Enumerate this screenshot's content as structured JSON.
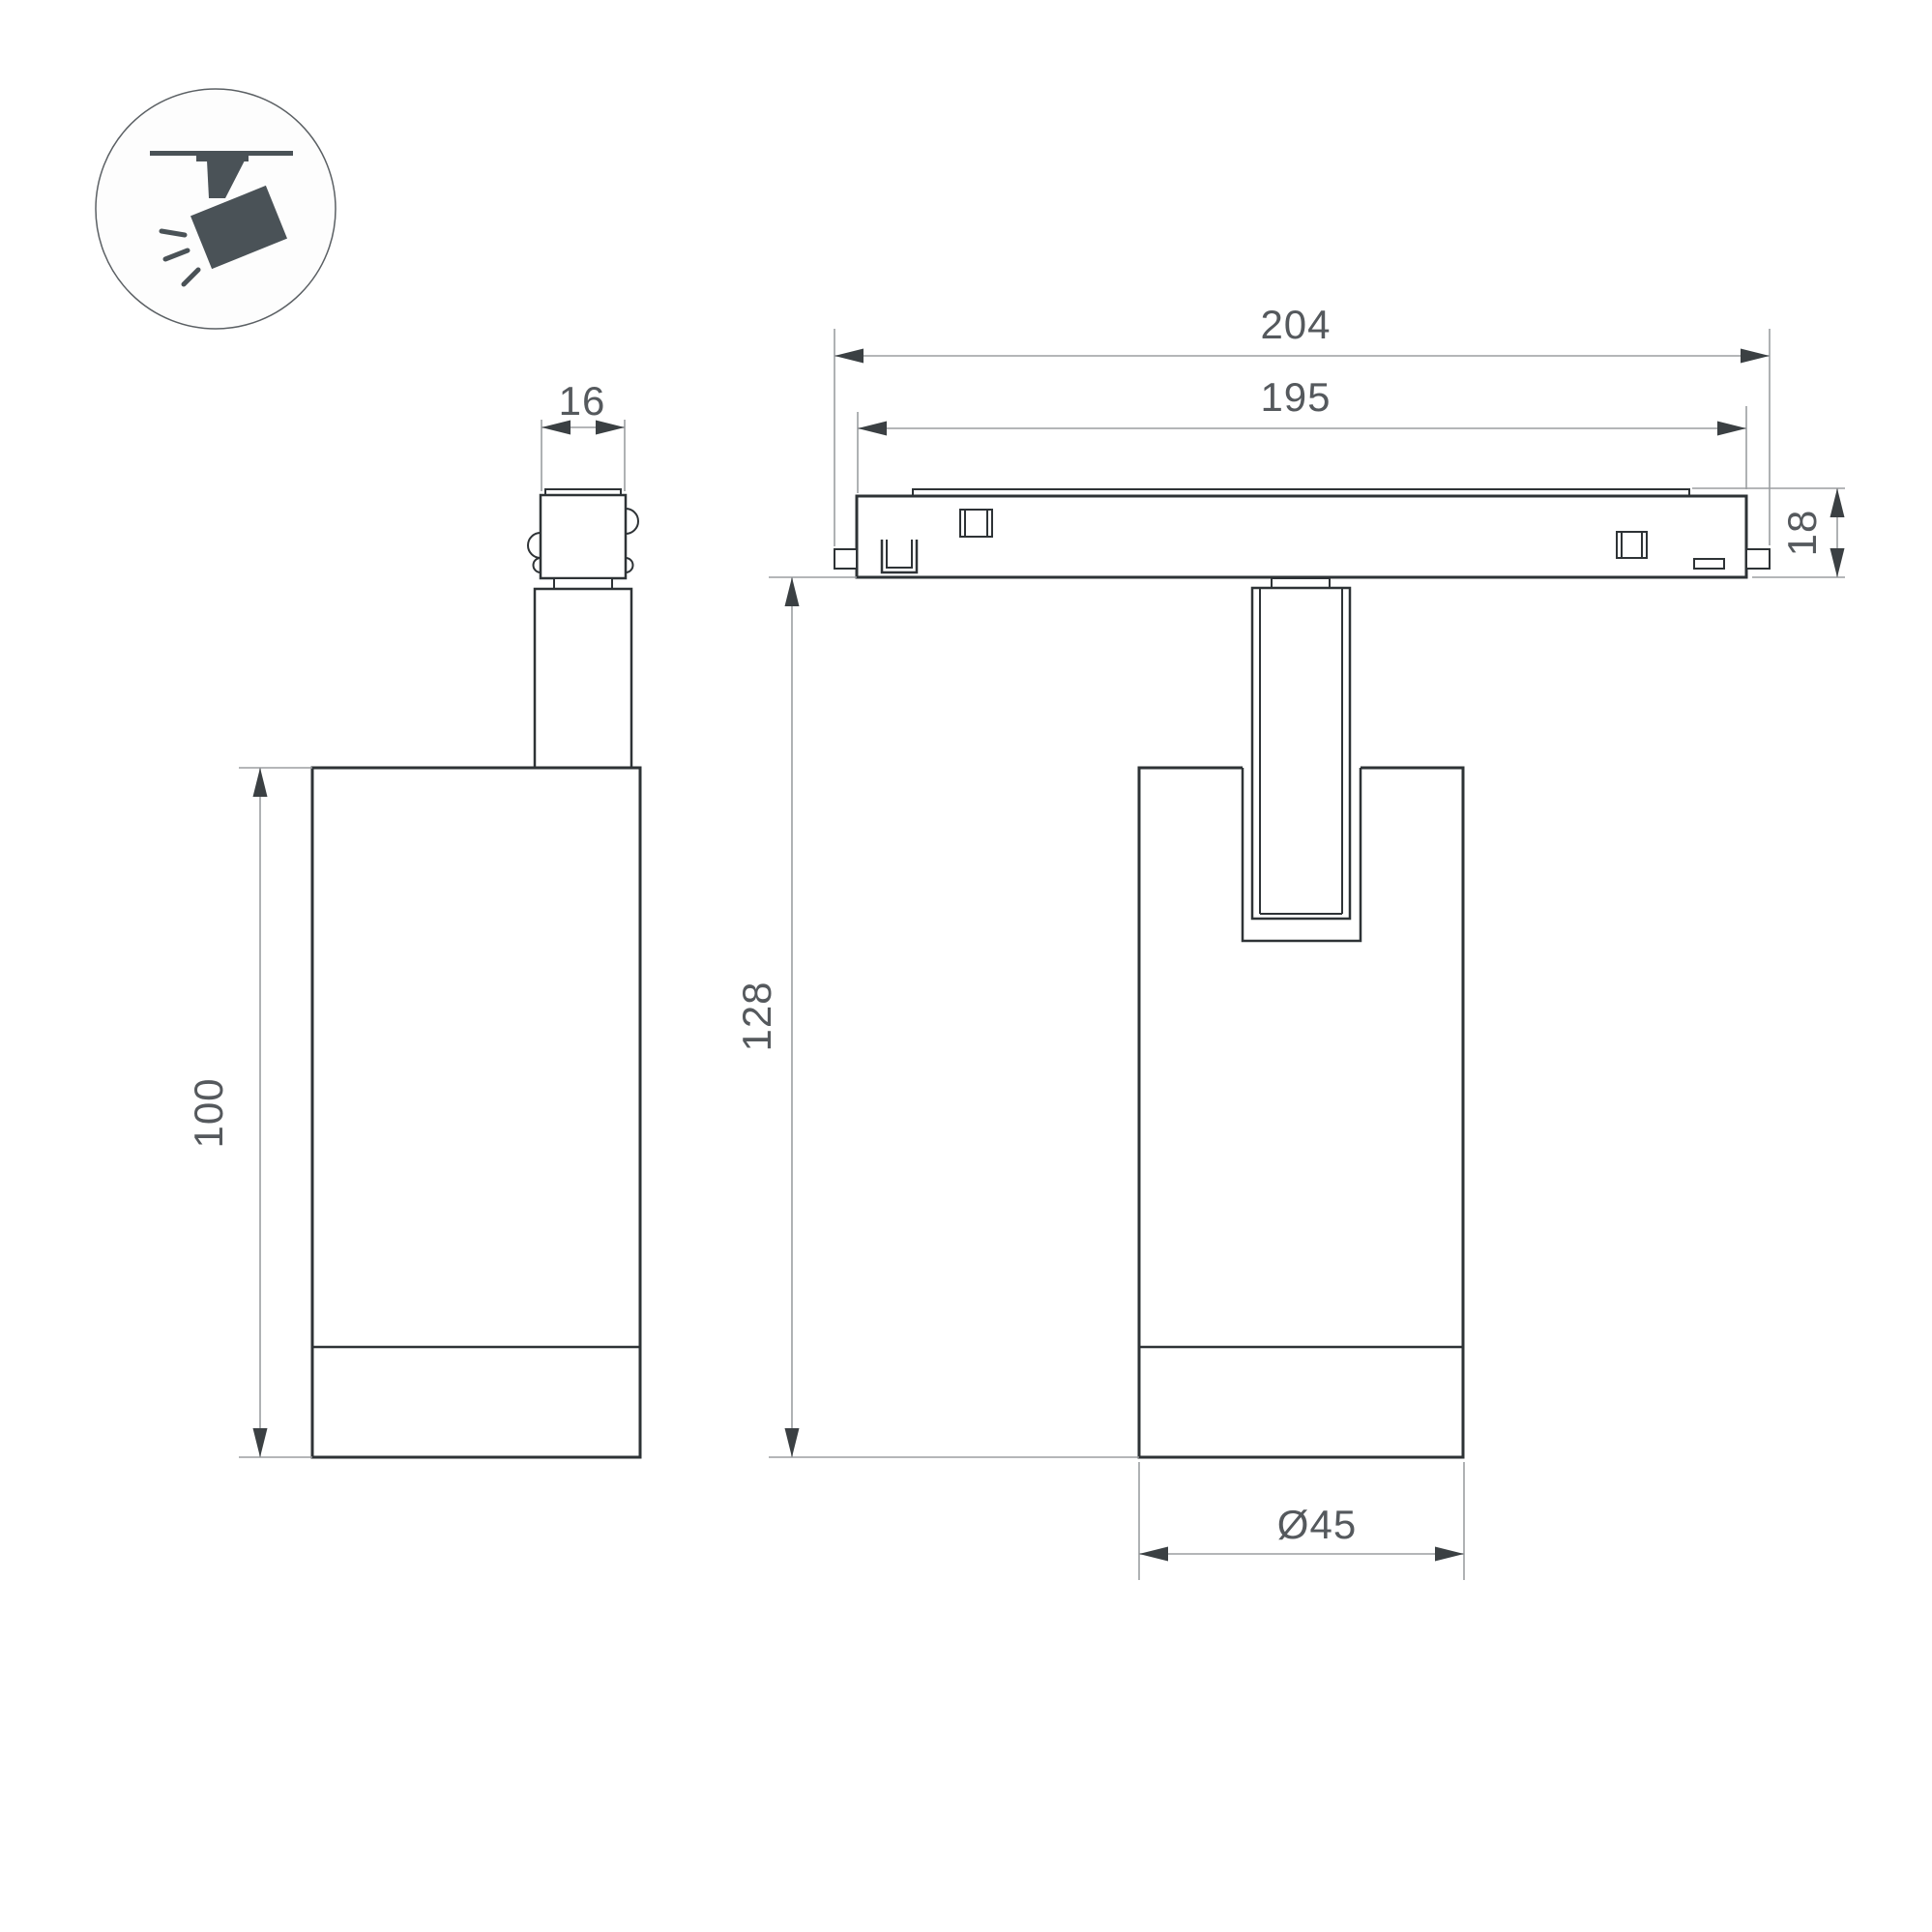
{
  "icon": {
    "name": "ceiling-track-spotlight-pictogram"
  },
  "dimensions": {
    "track_overall_length": "204",
    "track_body_length": "195",
    "adapter_width": "16",
    "track_height": "18",
    "overall_height": "128",
    "body_height": "100",
    "body_diameter": "Ø45"
  },
  "colors": {
    "outline": "#2e3336",
    "dim": "#9b9ea1",
    "arrow": "#3b4043",
    "text": "#55595d",
    "icon": "#4a5257",
    "iconline": "#5b6064",
    "bg": "#ffffff"
  }
}
